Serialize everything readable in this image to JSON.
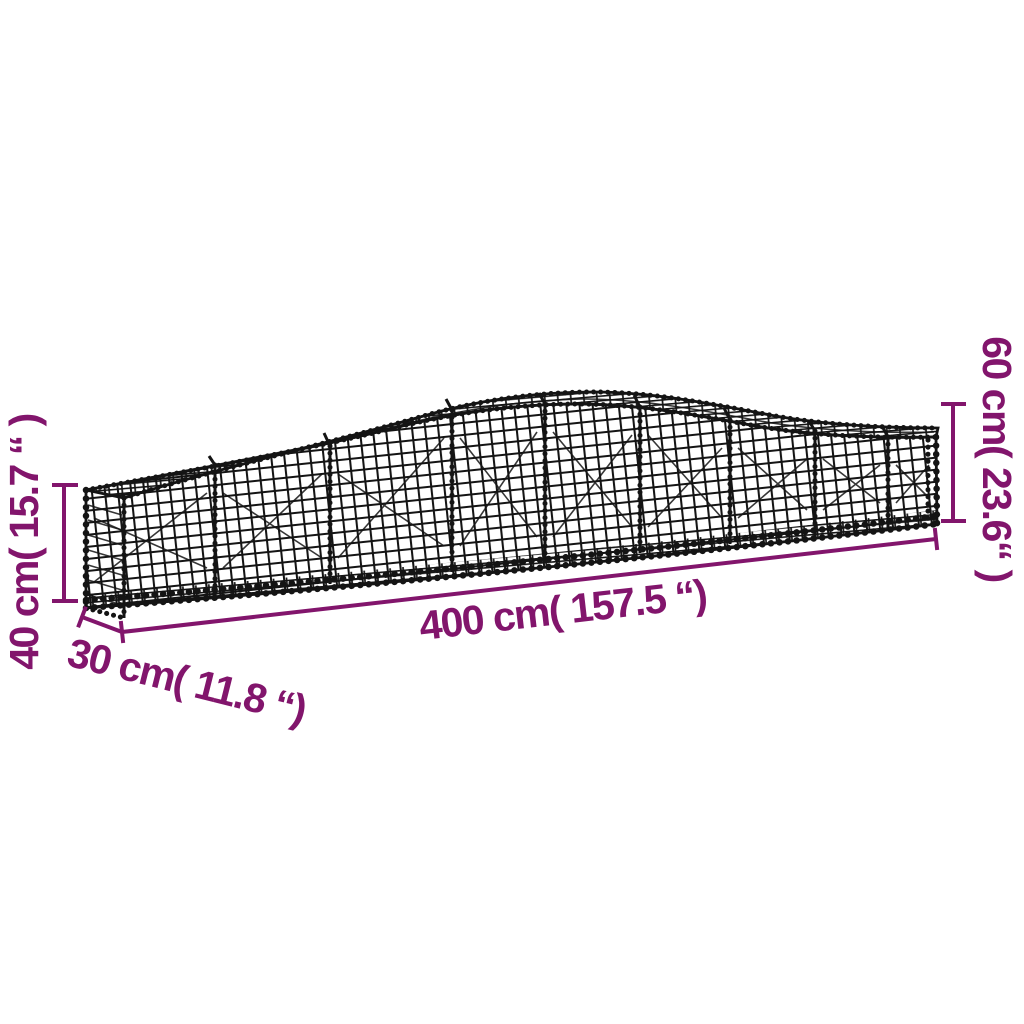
{
  "diagram": {
    "background_color": "#ffffff",
    "wire_color": "#141414",
    "dimension_color": "#82156C",
    "product_depicted": "arched gabion wire-mesh basket",
    "dimension_labels": {
      "length": "400 cm( 157.5 “)",
      "depth": "30 cm( 11.8 “)",
      "end_height": "40 cm( 15.7 “ )",
      "middle_height": "60 cm( 23.6“ )"
    },
    "dimension_values": {
      "length_cm": 400,
      "length_inch": 157.5,
      "depth_cm": 30,
      "depth_inch": 11.8,
      "end_height_cm": 40,
      "end_height_inch": 15.7,
      "middle_height_cm": 60,
      "middle_height_inch": 23.6
    }
  }
}
